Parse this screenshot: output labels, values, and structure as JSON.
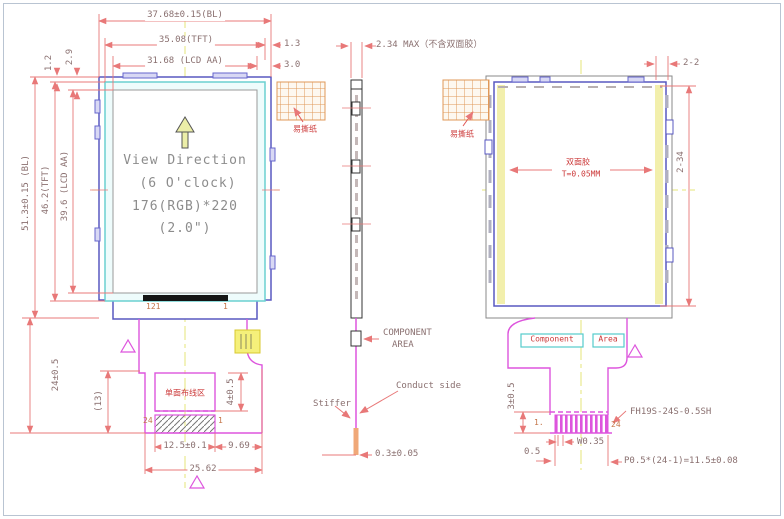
{
  "front": {
    "dim_bl_w": "37.68±0.15(BL)",
    "dim_tft_w": "35.08(TFT)",
    "dim_aa_w": "31.68 (LCD AA)",
    "dim_1_3": "1.3",
    "dim_3_0": "3.0",
    "dim_2_9": "2.9",
    "dim_1_2": "1.2",
    "dim_aa_h": "39.6 (LCD AA)",
    "dim_tft_h": "46.2(TFT)",
    "dim_bl_h": "51.3±0.15 (BL)",
    "dim_tail_h": "24±0.5",
    "dim_13": "(13)",
    "view_line1": "View Direction",
    "view_line2": "(6 O'clock)",
    "view_line3": "176(RGB)*220",
    "view_line4": "(2.0\")",
    "pin_left": "121",
    "pin_right": "1",
    "peel_label": "易撕纸",
    "wiring_label": "单面布线区",
    "pin_24": "24",
    "pin_1": "1",
    "dim_4": "4±0.5",
    "dim_125": "12.5±0.1",
    "dim_969": "9.69",
    "dim_2562": "25.62"
  },
  "side": {
    "dim_thickness": "2.34 MAX（不含双面胶）",
    "component_line1": "COMPONENT",
    "component_line2": "AREA",
    "conduct_side": "Conduct side",
    "stiffer": "Stiffer",
    "dim_stiffener": "0.3±0.05"
  },
  "back": {
    "peel_label": "易撕纸",
    "tape_line1": "双面胶",
    "tape_line2": "T=0.05MM",
    "dim_2_2": "2-2",
    "dim_2_34": "2-34",
    "component_label": "Component",
    "area_label": "Area",
    "dim_3": "3±0.5",
    "pin_1": "1.",
    "pin_24": "24",
    "connector_pn": "FH19S-24S-0.5SH",
    "dim_w": "W0.35",
    "dim_05": "0.5",
    "dim_pitch": "P0.5*(24-1)=11.5±0.08"
  },
  "colors": {
    "dim_line": "#e87878",
    "outline_blue": "#5858c0",
    "fpc_magenta": "#dd55dd",
    "tape_yellow": "#f2efac",
    "peel_orange": "#e09858"
  }
}
